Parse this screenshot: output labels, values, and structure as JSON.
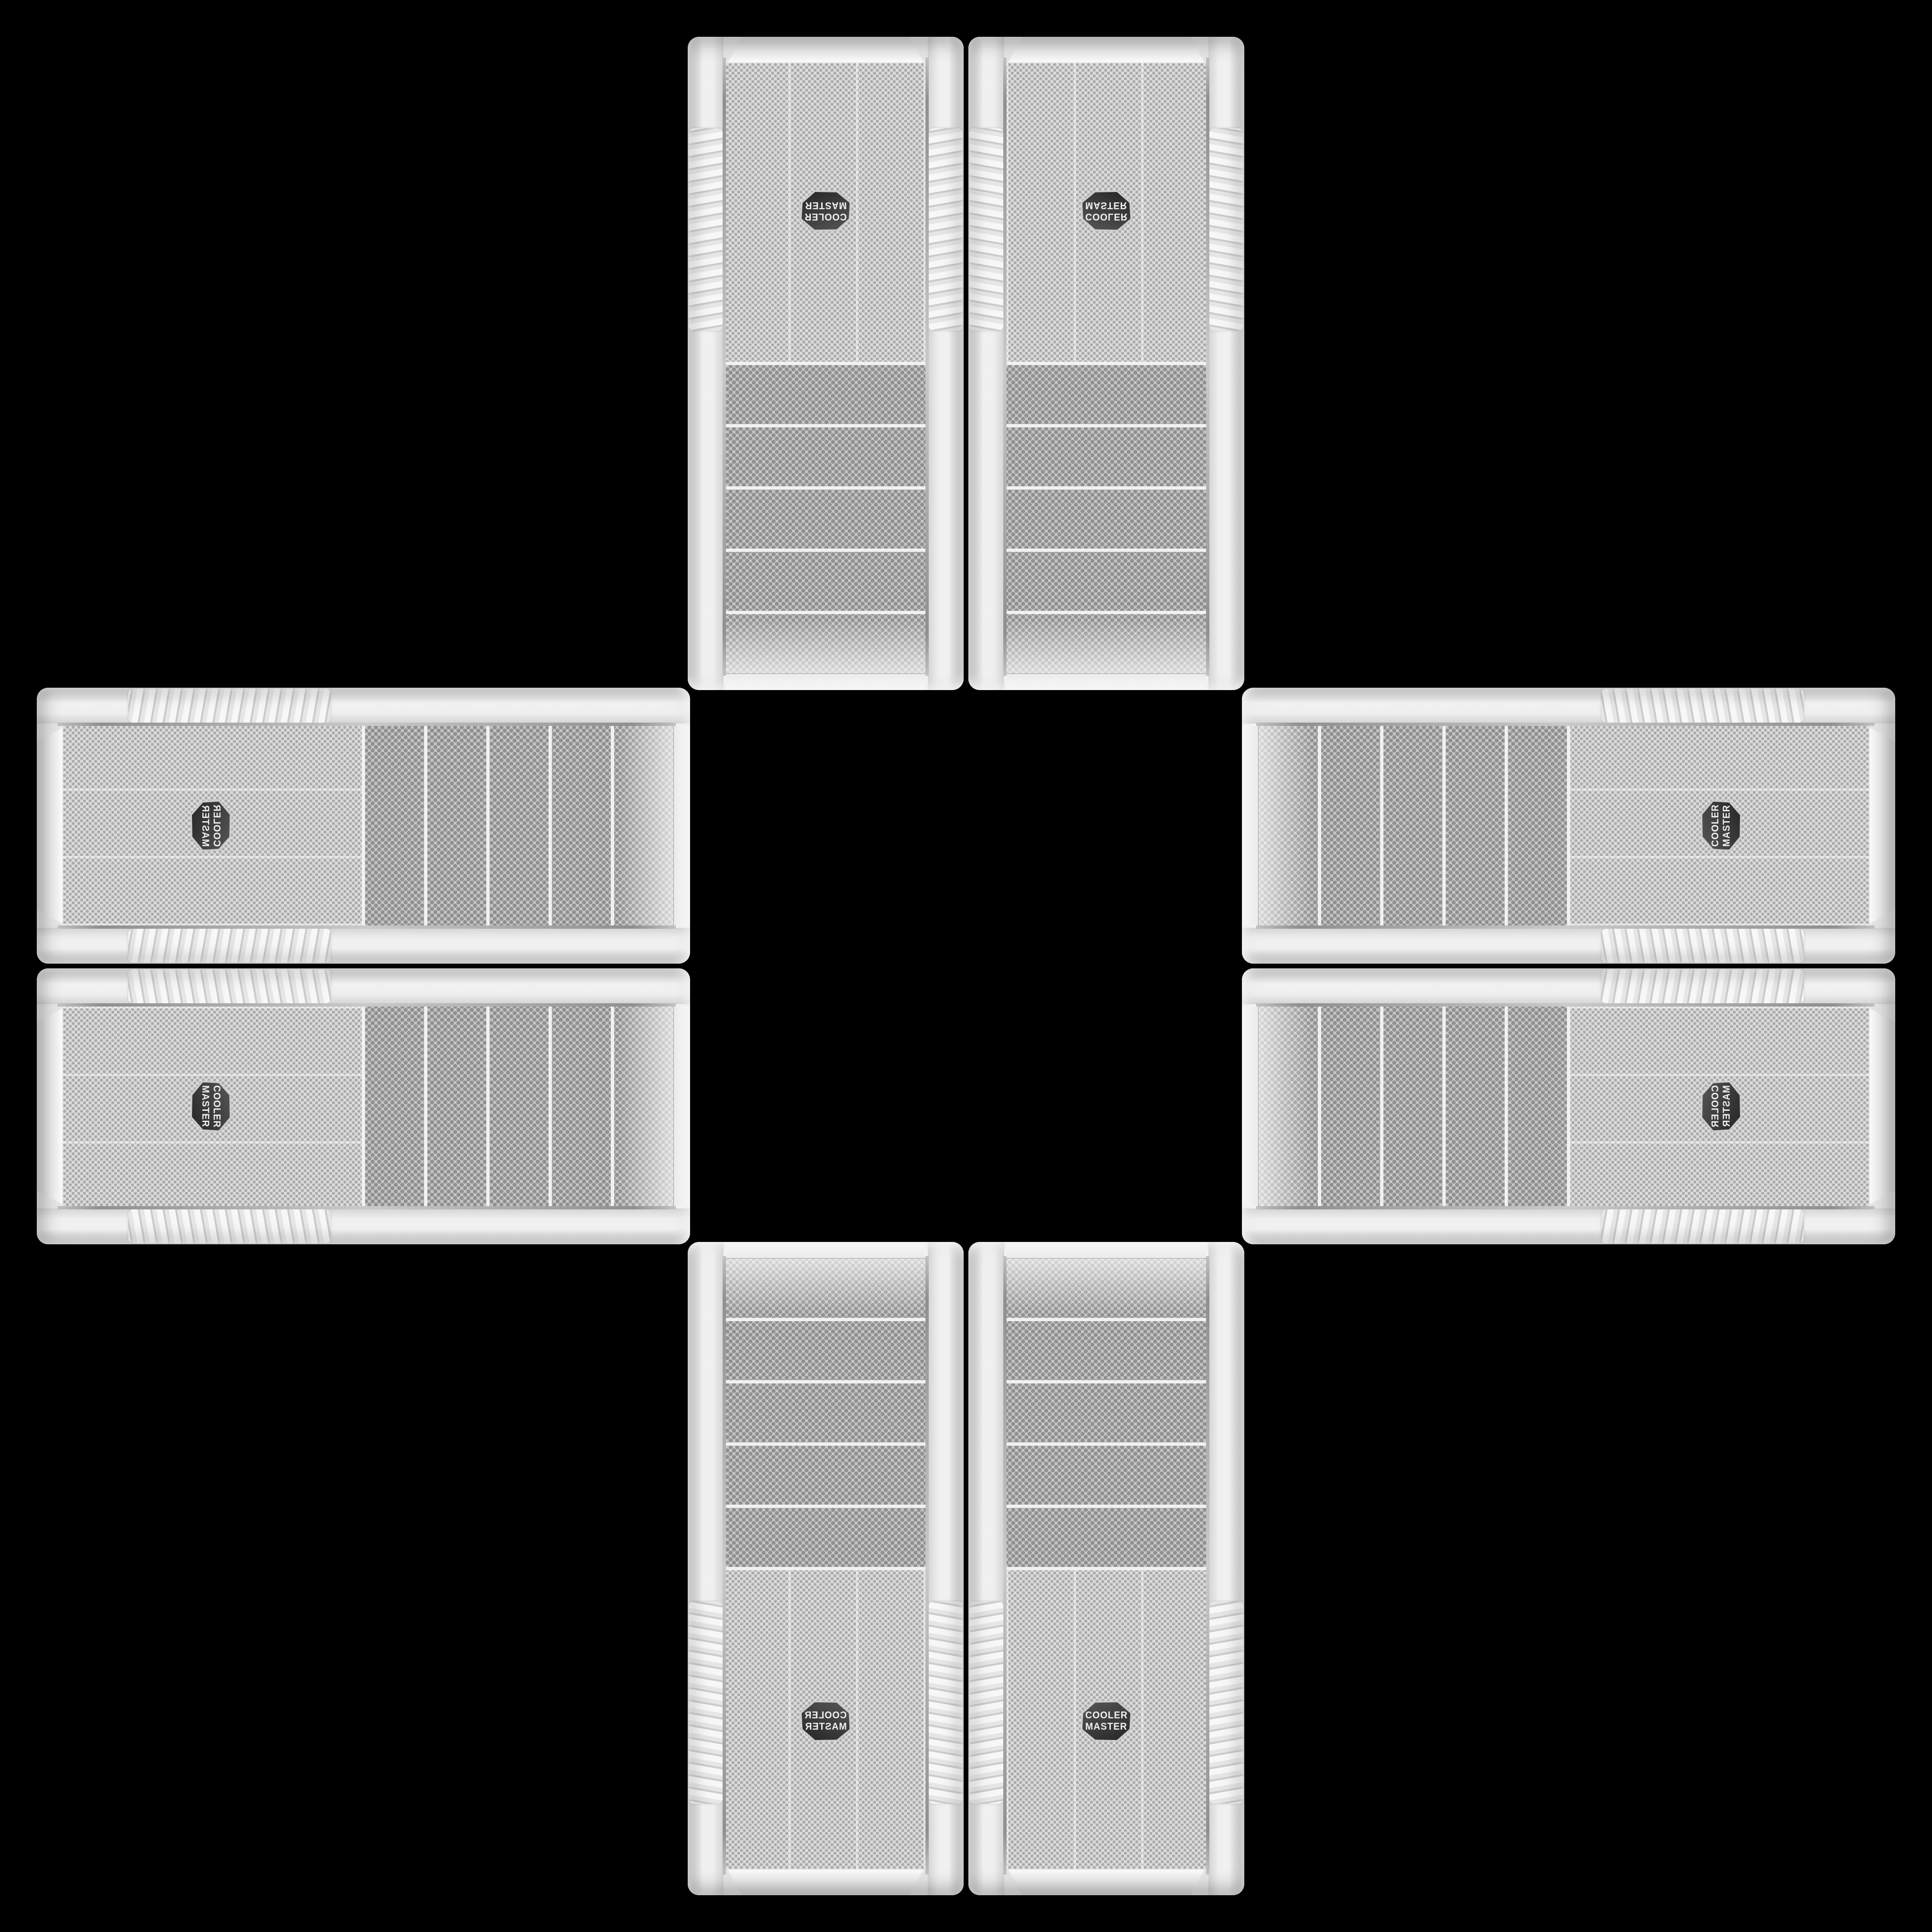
{
  "image_type": "product-photo-collage",
  "description": "Eight identical white Cooler Master PC tower front panels arranged in a plus/cross kaleidoscope pattern on a black background; each arm holds a mirrored pair, all panel tops pointing toward the empty centre",
  "background_color": "#000000",
  "brand": {
    "line1": "COOLER",
    "line2": "MASTER",
    "full_name": "Cooler Master"
  },
  "colors": {
    "bg": "#000000",
    "case-body": "#f4f4f4",
    "rail-light": "#f6f6f6",
    "chrome": "#8f8f8f",
    "mesh-coarse-base": "#c8c8c8",
    "mesh-coarse-hole": "#909090",
    "mesh-fine-base": "#dedede",
    "mesh-fine-hole": "#ababab",
    "badge-rim": "#cccccc",
    "badge-dark": "#262626",
    "badge-text": "#f0f0f0"
  },
  "layout": {
    "pattern": "plus-cross",
    "total_cases": 8,
    "cases_per_arm": 2,
    "arms": [
      "top",
      "right",
      "bottom",
      "left"
    ],
    "center": "empty black square"
  },
  "case_features": {
    "drive_bay_mesh_strips": 5,
    "badge_shape": "hexagon",
    "badge_position": "lower third of front mesh",
    "side_rails": "white with ribbed grip section",
    "mesh": "perforated honeycomb"
  },
  "cases": [
    {
      "id": "top-left",
      "arm": "top",
      "transform": "rot180",
      "badge_reads": "rotated 180°"
    },
    {
      "id": "top-right",
      "arm": "top",
      "transform": "mirror-y",
      "badge_reads": "flipped vertically"
    },
    {
      "id": "right-top",
      "arm": "right",
      "transform": "rot90ccw",
      "badge_reads": "rotated 90° ccw"
    },
    {
      "id": "right-bottom",
      "arm": "right",
      "transform": "rot90ccw-mirror",
      "badge_reads": "rotated 90° ccw, mirrored"
    },
    {
      "id": "bottom-right",
      "arm": "bottom",
      "transform": "identity",
      "badge_reads": "upright"
    },
    {
      "id": "bottom-left",
      "arm": "bottom",
      "transform": "mirror-x",
      "badge_reads": "mirrored horizontally"
    },
    {
      "id": "left-bottom",
      "arm": "left",
      "transform": "rot90cw",
      "badge_reads": "rotated 90° cw"
    },
    {
      "id": "left-top",
      "arm": "left",
      "transform": "rot90cw-mirror",
      "badge_reads": "rotated 90° cw, mirrored"
    }
  ]
}
